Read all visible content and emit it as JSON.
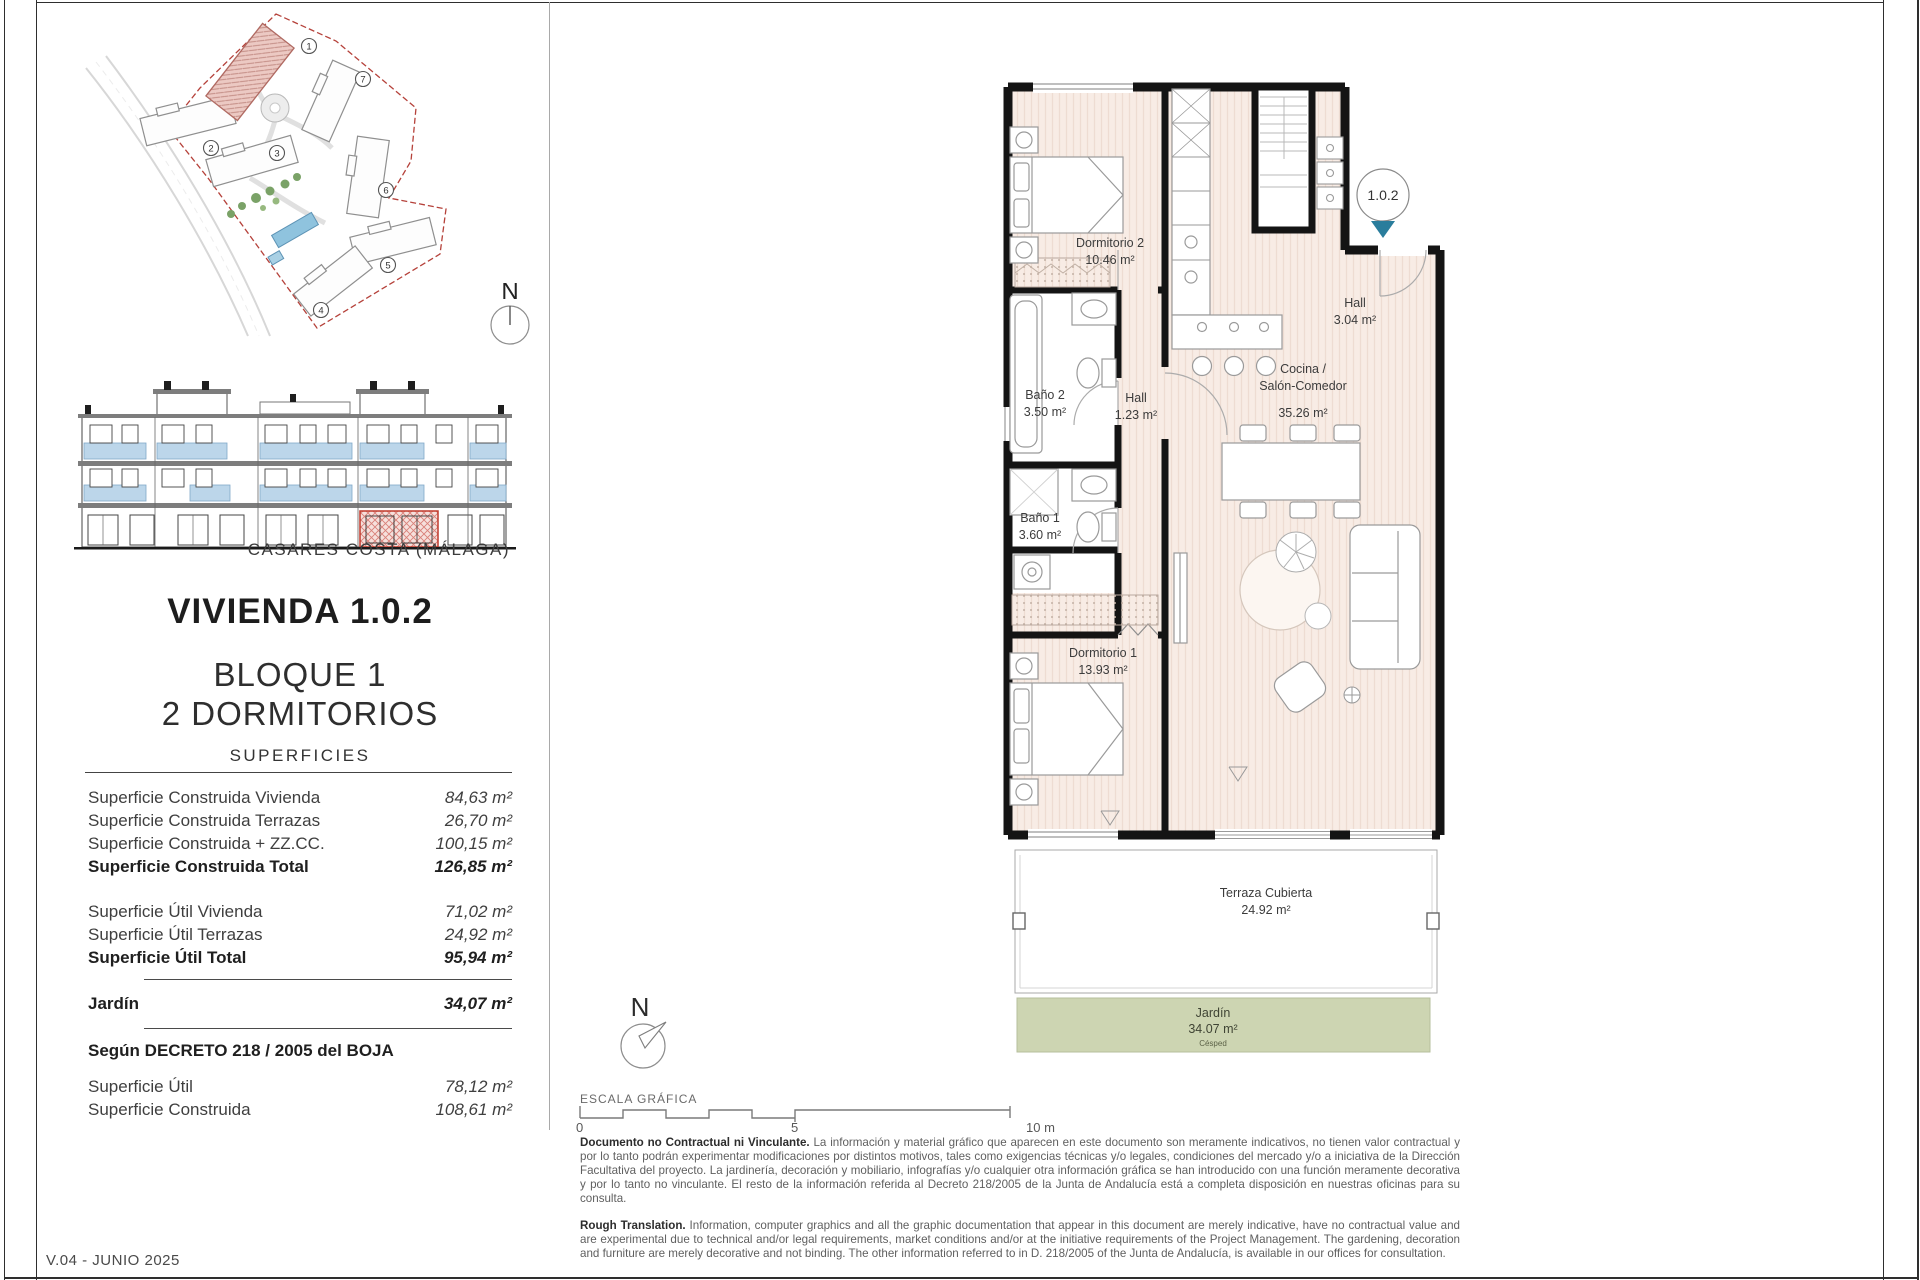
{
  "page": {
    "version_label": "V.04 - JUNIO 2025"
  },
  "header": {
    "location_label": "CASARES COSTA (MÁLAGA)"
  },
  "title": {
    "main": "VIVIENDA 1.0.2",
    "line1": "BLOQUE 1",
    "line2": "2 DORMITORIOS"
  },
  "surfaces": {
    "heading": "SUPERFICIES",
    "rows": [
      {
        "label": "Superficie Construida Vivienda",
        "value": "84,63 m²"
      },
      {
        "label": "Superficie Construida Terrazas",
        "value": "26,70 m²"
      },
      {
        "label": "Superficie Construida + ZZ.CC.",
        "value": "100,15 m²"
      },
      {
        "label": "Superficie Construida Total",
        "value": "126,85 m²"
      },
      {
        "label": "Superficie Útil Vivienda",
        "value": "71,02 m²"
      },
      {
        "label": "Superficie Útil Terrazas",
        "value": "24,92 m²"
      },
      {
        "label": "Superficie Útil Total",
        "value": "95,94 m²"
      },
      {
        "label": "Jardín",
        "value": "34,07 m²"
      }
    ],
    "decreto": {
      "heading": "Según DECRETO 218 / 2005 del BOJA",
      "rows": [
        {
          "label": "Superficie Útil",
          "value": "78,12 m²"
        },
        {
          "label": "Superficie Construida",
          "value": "108,61 m²"
        }
      ]
    }
  },
  "site_plan": {
    "compass": "N",
    "building_numbers": [
      "1",
      "2",
      "3",
      "4",
      "5",
      "6",
      "7"
    ]
  },
  "plan": {
    "badge": "1.0.2",
    "rooms": [
      {
        "name": "Dormitorio 2",
        "area": "10.46 m²"
      },
      {
        "name": "Baño 2",
        "area": "3.50 m²"
      },
      {
        "name": "Hall",
        "area": "1.23 m²"
      },
      {
        "name": "Hall",
        "area": "3.04 m²"
      },
      {
        "name": "Cocina /",
        "name2": "Salón-Comedor",
        "area": "35.26 m²"
      },
      {
        "name": "Baño 1",
        "area": "3.60 m²"
      },
      {
        "name": "Dormitorio 1",
        "area": "13.93 m²"
      },
      {
        "name": "Terraza Cubierta",
        "area": "24.92 m²"
      },
      {
        "name": "Jardín",
        "area": "34.07 m²",
        "surface": "Césped"
      }
    ]
  },
  "scale": {
    "label": "ESCALA GRÁFICA",
    "compass": "N",
    "tick0": "0",
    "tick5": "5",
    "tick10": "10 m"
  },
  "disclaimer": {
    "es_bold": "Documento no Contractual ni Vinculante.",
    "es_text": " La información y material gráfico que aparecen en este documento son meramente indicativos, no tienen valor contractual y por lo tanto podrán experimentar modificaciones por distintos motivos, tales como exigencias técnicas y/o legales, condiciones del mercado y/o a iniciativa de la Dirección Facultativa del proyecto. La jardinería, decoración y mobiliario, infografías y/o cualquier otra información gráfica se han introducido con una función meramente decorativa y por lo tanto no vinculante. El resto de la información referida al Decreto 218/2005 de la Junta de Andalucía está a completa disposición en nuestras oficinas para su consulta.",
    "en_bold": "Rough Translation.",
    "en_text": " Information, computer graphics and all the graphic documentation that appear in this document are merely indicative, have no contractual value and are experimental due to technical and/or legal requirements, market conditions and/or at the initiative requirements of the Project Management. The gardening, decoration and furniture are merely decorative and not binding. The other information referred to in D. 218/2005 of the Junta de Andalucía, is available in our offices for consultation."
  },
  "colors": {
    "accent_teal": "#2a7d9c",
    "plan_floor": "#f8ece5",
    "garden_green": "#cdd5b2",
    "boundary_red": "#b5413a",
    "elevation_blue": "#bcd6ea",
    "highlight_red": "#c0392b"
  }
}
